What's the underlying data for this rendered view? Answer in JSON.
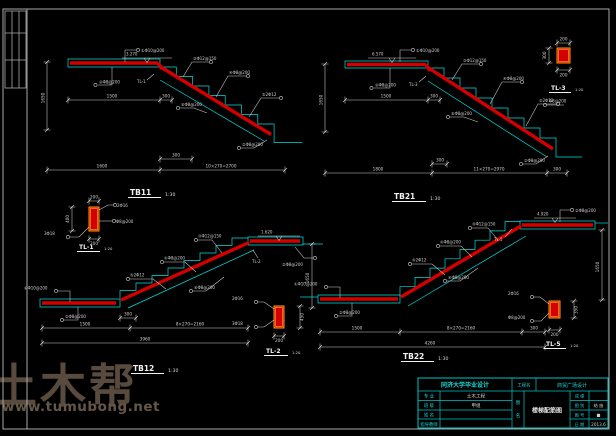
{
  "watermark": {
    "brand": "土木帮",
    "url": "www.tumubong.net"
  },
  "colors": {
    "background": "#000000",
    "line_cyan": "#00dede",
    "rebar_red": "#d40000",
    "detail_orange": "#ff9d00",
    "dim_gray": "#cfcfcf",
    "title_white": "#f2f2f2",
    "frame_gray": "#a8a8a8",
    "titleblock_cyan": "#00c6c6",
    "titleblock_text": "#1ad8d8"
  },
  "stairs": {
    "tb11": {
      "title": "TB11",
      "scale": "1:30",
      "level": "3.270",
      "ref": "TL-1",
      "callouts": {
        "slab_top": "①Φ10@200",
        "slab_bot": "②Φ8@200",
        "slope1": "③Φ12@150",
        "slope2": "④Φ8@200",
        "slope3": "⑤2Φ12",
        "below": "⑥Φ8@200",
        "end": "②Φ8@200"
      },
      "dims": {
        "v": "1650",
        "t1": "1500",
        "t2": "300",
        "b1": "1600",
        "b2": "10×270=2700",
        "s1": "300"
      }
    },
    "tb21": {
      "title": "TB21",
      "scale": "1:30",
      "level": "6.570",
      "ref": "TL-3",
      "callouts": {
        "slab_top": "①Φ10@200",
        "slab_bot": "②Φ8@200",
        "slope1": "③Φ12@150",
        "slope2": "④Φ8@200",
        "slope3": "⑤2Φ12",
        "below": "⑥Φ8@200",
        "end": "②Φ8@200"
      },
      "dims": {
        "v": "1650",
        "t1": "1500",
        "t2": "300",
        "b1": "1800",
        "b2": "11×270=2970",
        "s1": "300"
      }
    },
    "tb12": {
      "title": "TB12",
      "scale": "1:30",
      "level": "1.620",
      "ref": "TL-2",
      "callouts": {
        "slab_top": "①Φ10@200",
        "slab_bot": "②Φ8@200",
        "slope1": "③Φ12@150",
        "slope2": "④Φ8@200",
        "slope3": "⑤2Φ12",
        "below": "⑥Φ8@200",
        "end": "②Φ8@200"
      },
      "dims": {
        "v": "1650",
        "b1": "1500",
        "b2": "8×270=2160",
        "s1": "300",
        "total": "3960"
      }
    },
    "tb22": {
      "title": "TB22",
      "scale": "1:30",
      "level": "4.920",
      "ref": "TL-5",
      "callouts": {
        "slab_top": "①Φ10@200",
        "slab_bot": "②Φ8@200",
        "slope1": "③Φ12@150",
        "slope2": "④Φ8@200",
        "slope3": "⑤2Φ12",
        "below": "⑥Φ8@200",
        "end": "②Φ8@200"
      },
      "dims": {
        "v": "1650",
        "b1": "1500",
        "b2": "8×270=2160",
        "s1": "300",
        "total": "4260"
      }
    }
  },
  "details": {
    "tl1": {
      "title": "TL-1",
      "scale": "1:20",
      "dims": {
        "w": "200",
        "h": "400",
        "b": "200"
      },
      "callouts": {
        "a": "2Φ16",
        "b": "Φ8@200",
        "c": "3Φ18"
      }
    },
    "tl2": {
      "title": "TL-2",
      "scale": "1:20",
      "dims": {
        "w": "200",
        "h": "450"
      },
      "callouts": {
        "a": "2Φ16",
        "b": "3Φ18"
      }
    },
    "tl3": {
      "title": "TL-3",
      "scale": "1:20",
      "dims": {
        "w": "200",
        "h": "300",
        "b": "200"
      },
      "callouts": {
        "a": "Φ8@200"
      }
    },
    "tl5": {
      "title": "TL-5",
      "scale": "1:20",
      "dims": {
        "w": "200",
        "h": "350"
      },
      "callouts": {
        "a": "2Φ16",
        "b": "Φ8@200"
      }
    }
  },
  "titleblock": {
    "school": "同济大学毕业设计",
    "project_label": "工程名",
    "project": "商贸广场设计",
    "rows": [
      {
        "label": "专 业",
        "value": "土木工程"
      },
      {
        "label": "班 级",
        "value": "甲组"
      },
      {
        "label": "姓 名",
        "value": ""
      },
      {
        "label": "指导教师",
        "value": ""
      }
    ],
    "sheet_label_top": "图",
    "sheet_label_bottom": "名",
    "sheet_name": "楼梯配筋图",
    "cells": {
      "r1l": "成 绩",
      "r1r": "",
      "r2l": "图 别",
      "r2r": "结 施",
      "r3l": "图 号",
      "r3r": "■",
      "r4l": "日 期",
      "r4r": "2013.6"
    }
  }
}
